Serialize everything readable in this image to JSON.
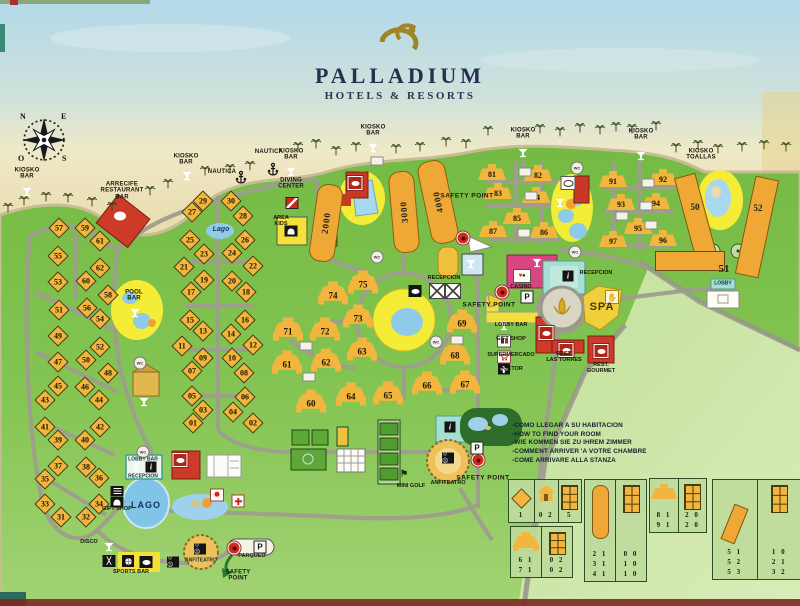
{
  "header": {
    "brand": "PALLADIUM",
    "tagline": "HOTELS & RESORTS"
  },
  "compass": {
    "n": "N",
    "e": "E",
    "o": "O",
    "s": "S"
  },
  "buildings": {
    "diamonds": [
      [
        57,
        59,
        228
      ],
      [
        59,
        85,
        228
      ],
      [
        61,
        100,
        241
      ],
      [
        55,
        58,
        256
      ],
      [
        62,
        100,
        268
      ],
      [
        60,
        86,
        281
      ],
      [
        53,
        58,
        282
      ],
      [
        58,
        108,
        295
      ],
      [
        56,
        87,
        308
      ],
      [
        51,
        59,
        310
      ],
      [
        54,
        100,
        319
      ],
      [
        49,
        58,
        336
      ],
      [
        52,
        100,
        347
      ],
      [
        50,
        86,
        360
      ],
      [
        47,
        58,
        362
      ],
      [
        48,
        108,
        373
      ],
      [
        45,
        58,
        386
      ],
      [
        46,
        85,
        387
      ],
      [
        43,
        45,
        400
      ],
      [
        44,
        99,
        400
      ],
      [
        41,
        45,
        427
      ],
      [
        42,
        100,
        427
      ],
      [
        39,
        58,
        440
      ],
      [
        40,
        85,
        440
      ],
      [
        37,
        58,
        466
      ],
      [
        38,
        86,
        467
      ],
      [
        35,
        45,
        479
      ],
      [
        36,
        99,
        478
      ],
      [
        33,
        45,
        504
      ],
      [
        34,
        99,
        504
      ],
      [
        31,
        61,
        517
      ],
      [
        32,
        86,
        517
      ],
      [
        29,
        203,
        201
      ],
      [
        30,
        231,
        201
      ],
      [
        27,
        192,
        212
      ],
      [
        28,
        243,
        216
      ],
      [
        25,
        190,
        240
      ],
      [
        26,
        245,
        240
      ],
      [
        23,
        204,
        254
      ],
      [
        24,
        232,
        253
      ],
      [
        21,
        184,
        267
      ],
      [
        22,
        253,
        266
      ],
      [
        19,
        204,
        280
      ],
      [
        20,
        232,
        281
      ],
      [
        17,
        191,
        292
      ],
      [
        18,
        246,
        292
      ],
      [
        15,
        190,
        320
      ],
      [
        16,
        245,
        320
      ],
      [
        13,
        203,
        331
      ],
      [
        14,
        231,
        334
      ],
      [
        11,
        182,
        346
      ],
      [
        12,
        253,
        345
      ],
      [
        "09",
        203,
        358
      ],
      [
        10,
        232,
        358
      ],
      [
        "07",
        192,
        371
      ],
      [
        "08",
        244,
        373
      ],
      [
        "05",
        192,
        396
      ],
      [
        "06",
        245,
        397
      ],
      [
        "03",
        203,
        410
      ],
      [
        "04",
        233,
        412
      ],
      [
        "01",
        193,
        423
      ],
      [
        "02",
        253,
        423
      ]
    ],
    "bells": [
      [
        60,
        311,
        401
      ],
      [
        61,
        287,
        362
      ],
      [
        62,
        326,
        360
      ],
      [
        63,
        362,
        349
      ],
      [
        64,
        351,
        394
      ],
      [
        65,
        388,
        393
      ],
      [
        66,
        427,
        383
      ],
      [
        67,
        465,
        382
      ],
      [
        68,
        455,
        353
      ],
      [
        69,
        462,
        321
      ],
      [
        71,
        288,
        329
      ],
      [
        72,
        325,
        329
      ],
      [
        73,
        358,
        316
      ],
      [
        74,
        333,
        293
      ],
      [
        75,
        363,
        282
      ]
    ],
    "traps": [
      [
        81,
        492,
        172
      ],
      [
        82,
        538,
        173
      ],
      [
        83,
        498,
        191
      ],
      [
        84,
        536,
        195
      ],
      [
        85,
        517,
        216
      ],
      [
        86,
        544,
        230
      ],
      [
        87,
        493,
        229
      ],
      [
        91,
        613,
        179
      ],
      [
        92,
        663,
        177
      ],
      [
        93,
        621,
        202
      ],
      [
        94,
        656,
        201
      ],
      [
        95,
        638,
        226
      ],
      [
        96,
        663,
        238
      ],
      [
        97,
        613,
        239
      ]
    ],
    "towers": [
      [
        "2000",
        326,
        223,
        8,
        24,
        76
      ],
      [
        "3000",
        404,
        212,
        -5,
        24,
        80
      ],
      [
        "4000",
        438,
        202,
        -12,
        26,
        82
      ]
    ],
    "slant_rects": [
      [
        686,
        174,
        20,
        94,
        -15
      ],
      [
        745,
        177,
        22,
        98,
        12
      ]
    ],
    "long51": {
      "x": 690,
      "y": 261,
      "w": 68,
      "h": 18
    }
  },
  "labels": [
    [
      "KIOSKO\nBAR",
      27,
      174,
      "t"
    ],
    [
      "KIOSKO\nBAR",
      186,
      160,
      "t"
    ],
    [
      "KIOSKO\nBAR",
      291,
      155,
      "t"
    ],
    [
      "KIOSKO\nBAR",
      373,
      131,
      "t"
    ],
    [
      "KIOSKO\nBAR",
      523,
      134,
      "t"
    ],
    [
      "KIOSKO\nBAR",
      641,
      135,
      "t"
    ],
    [
      "KIOSKO\nTOALLAS",
      701,
      155,
      "t"
    ],
    [
      "NAUTICA",
      222,
      172,
      "t"
    ],
    [
      "NAUTICA",
      269,
      152,
      "t"
    ],
    [
      "ARRECIFE\nRESTAURANT\nBAR",
      122,
      191,
      "t"
    ],
    [
      "DIVING\nCENTER",
      291,
      184,
      "t"
    ],
    [
      "AREA\nKIDS",
      281,
      222,
      "t5"
    ],
    [
      "Lago",
      221,
      230,
      "it"
    ],
    [
      "POOL\nBAR",
      134,
      296,
      "t"
    ],
    [
      "SPA",
      602,
      308,
      "spa"
    ],
    [
      "LAGO",
      146,
      506,
      "lago"
    ],
    [
      "RECEPCION",
      444,
      279,
      "t5"
    ],
    [
      "RECEPCION",
      596,
      274,
      "t5"
    ],
    [
      "CASINO",
      521,
      288,
      "t5"
    ],
    [
      "LOBBY BAR",
      511,
      326,
      "tl"
    ],
    [
      "GIFT SHOP",
      511,
      340,
      "tl"
    ],
    [
      "SUPERMERCADO",
      511,
      356,
      "tl"
    ],
    [
      "DOCTOR",
      511,
      370,
      "tl"
    ],
    [
      "REST.\nLAS TORRES",
      564,
      358,
      "t5"
    ],
    [
      "REST.\nGOURMET",
      601,
      369,
      "t5"
    ],
    [
      "GIFT SHOP",
      117,
      510,
      "t5"
    ],
    [
      "LOBBY BAR",
      143,
      460,
      "t4"
    ],
    [
      "RECEPCION",
      143,
      477,
      "t4"
    ],
    [
      "ANFITEATRO",
      201,
      561,
      "t4"
    ],
    [
      "ANFITEATRO",
      448,
      484,
      "t5"
    ],
    [
      "PARQUEO",
      252,
      557,
      "t5"
    ],
    [
      "SAFETY\nPOINT",
      238,
      576,
      "t"
    ],
    [
      "DISCO",
      89,
      543,
      "t5"
    ],
    [
      "SPORTS BAR",
      131,
      573,
      "t5"
    ],
    [
      "MINI GOLF",
      411,
      487,
      "t5"
    ],
    [
      "LOBBY",
      723,
      284,
      "t4"
    ],
    [
      "SAFETY POINT",
      467,
      196,
      "v"
    ],
    [
      "SAFETY POINT",
      489,
      305,
      "v"
    ],
    [
      "SAFETY POINT",
      483,
      478,
      "v"
    ],
    [
      "50",
      695,
      208,
      "num"
    ],
    [
      "52",
      758,
      209,
      "num"
    ],
    [
      "51",
      724,
      270,
      "num10"
    ]
  ],
  "icons": [
    [
      "martini",
      27,
      192
    ],
    [
      "martini",
      187,
      176
    ],
    [
      "martini",
      291,
      172
    ],
    [
      "martini",
      373,
      148
    ],
    [
      "martini",
      523,
      153
    ],
    [
      "martini",
      641,
      156
    ],
    [
      "martini",
      135,
      313
    ],
    [
      "martini",
      471,
      264
    ],
    [
      "martini",
      537,
      263
    ],
    [
      "martini",
      560,
      203
    ],
    [
      "martini",
      144,
      402
    ],
    [
      "martini",
      136,
      467
    ],
    [
      "martini",
      109,
      547
    ],
    [
      "martini",
      504,
      326
    ],
    [
      "martiniR",
      424,
      305
    ],
    [
      "anchor",
      241,
      178
    ],
    [
      "anchor",
      273,
      170
    ],
    [
      "wc",
      377,
      257
    ],
    [
      "wc",
      436,
      342
    ],
    [
      "wc",
      140,
      363
    ],
    [
      "wc",
      143,
      452
    ],
    [
      "wc",
      577,
      168
    ],
    [
      "wc",
      575,
      252
    ],
    [
      "dot",
      463,
      238
    ],
    [
      "dot",
      502,
      292
    ],
    [
      "dot",
      478,
      460
    ],
    [
      "dot",
      234,
      548
    ],
    [
      "P",
      527,
      297
    ],
    [
      "P",
      477,
      448
    ],
    [
      "P",
      260,
      547
    ],
    [
      "flag",
      292,
      203
    ],
    [
      "info",
      568,
      276
    ],
    [
      "info",
      450,
      427
    ],
    [
      "info",
      151,
      467
    ],
    [
      "cards",
      522,
      276
    ],
    [
      "masks",
      173,
      562
    ],
    [
      "masks",
      200,
      549
    ],
    [
      "masks",
      448,
      458
    ],
    [
      "rest",
      415,
      291
    ],
    [
      "rest",
      146,
      562
    ],
    [
      "restR",
      546,
      333
    ],
    [
      "restR",
      566,
      350
    ],
    [
      "restR",
      601,
      351
    ],
    [
      "restR",
      355,
      183
    ],
    [
      "restR",
      180,
      460
    ],
    [
      "restW",
      568,
      183
    ],
    [
      "burger",
      117,
      491
    ],
    [
      "arch",
      117,
      502
    ],
    [
      "arch",
      291,
      231
    ],
    [
      "shop",
      504,
      341
    ],
    [
      "cart",
      504,
      357
    ],
    [
      "crossB",
      504,
      369
    ],
    [
      "gear",
      217,
      495
    ],
    [
      "crossR",
      238,
      501
    ],
    [
      "hand",
      612,
      297
    ],
    [
      "golf",
      404,
      474
    ],
    [
      "sportX",
      109,
      561
    ],
    [
      "ball",
      128,
      561
    ],
    [
      "xbox",
      437,
      291
    ],
    [
      "xbox",
      453,
      291
    ],
    [
      "chip",
      306,
      346
    ],
    [
      "chip",
      309,
      377
    ],
    [
      "chip",
      457,
      340
    ],
    [
      "chip",
      525,
      172
    ],
    [
      "chip",
      531,
      196
    ],
    [
      "chip",
      524,
      233
    ],
    [
      "chip",
      648,
      183
    ],
    [
      "chip",
      646,
      206
    ],
    [
      "chip",
      622,
      216
    ],
    [
      "chip",
      651,
      225
    ],
    [
      "chip",
      377,
      161
    ],
    [
      "palm",
      8,
      207
    ],
    [
      "palm",
      24,
      200
    ],
    [
      "palm",
      46,
      196
    ],
    [
      "palm",
      68,
      197
    ],
    [
      "palm",
      92,
      201
    ],
    [
      "palm",
      112,
      206
    ],
    [
      "palm",
      150,
      190
    ],
    [
      "palm",
      168,
      183
    ],
    [
      "palm",
      205,
      170
    ],
    [
      "palm",
      230,
      168
    ],
    [
      "palm",
      250,
      165
    ],
    [
      "palm",
      298,
      146
    ],
    [
      "palm",
      316,
      143
    ],
    [
      "palm",
      336,
      150
    ],
    [
      "palm",
      356,
      146
    ],
    [
      "palm",
      396,
      148
    ],
    [
      "palm",
      420,
      146
    ],
    [
      "palm",
      446,
      141
    ],
    [
      "palm",
      466,
      143
    ],
    [
      "palm",
      488,
      130
    ],
    [
      "palm",
      540,
      128
    ],
    [
      "palm",
      560,
      131
    ],
    [
      "palm",
      580,
      127
    ],
    [
      "palm",
      600,
      129
    ],
    [
      "palm",
      616,
      126
    ],
    [
      "palm",
      632,
      128
    ],
    [
      "palm",
      656,
      125
    ],
    [
      "palm",
      676,
      147
    ],
    [
      "palm",
      698,
      144
    ],
    [
      "palm",
      718,
      148
    ],
    [
      "palm",
      742,
      146
    ],
    [
      "palm",
      764,
      144
    ],
    [
      "palm",
      786,
      146
    ]
  ],
  "legend": {
    "panels": [
      {
        "x": 508,
        "y": 479,
        "w": 72,
        "h": 42,
        "cells": [
          {
            "shape": "diamond",
            "nums": [
              "1"
            ]
          },
          {
            "shape": "house",
            "nums": [
              "0 2"
            ]
          },
          {
            "shape": "grid",
            "nums": [
              "5"
            ]
          }
        ]
      },
      {
        "x": 510,
        "y": 526,
        "w": 61,
        "h": 50,
        "cells": [
          {
            "shape": "bell",
            "nums": [
              "6 1",
              "7 1"
            ]
          },
          {
            "shape": "grid",
            "nums": [
              "0 2",
              "0 2"
            ]
          }
        ]
      },
      {
        "x": 584,
        "y": 479,
        "w": 61,
        "h": 101,
        "cells": [
          {
            "shape": "tower",
            "nums": [
              "2 1",
              "3 1",
              "4 1"
            ]
          },
          {
            "shape": "grid",
            "nums": [
              "0 0",
              "1 0",
              "1 0"
            ]
          }
        ]
      },
      {
        "x": 649,
        "y": 478,
        "w": 56,
        "h": 53,
        "cells": [
          {
            "shape": "trap",
            "nums": [
              "8 1",
              "9 1"
            ]
          },
          {
            "shape": "grid",
            "nums": [
              "2 0",
              "2 0"
            ]
          }
        ]
      },
      {
        "x": 712,
        "y": 479,
        "w": 88,
        "h": 99,
        "cells": [
          {
            "shape": "slant",
            "nums": [
              "5 1",
              "5 2",
              "5 3"
            ]
          },
          {
            "shape": "grid",
            "nums": [
              "1 0",
              "2 1",
              "3 2"
            ]
          }
        ]
      }
    ]
  },
  "howto": {
    "lines": [
      "-COMO LLEGAR A SU HABITACION",
      "-HOW TO FIND YOUR ROOM",
      "-WIE KOMMEN SIE ZU IHREM ZIMMER",
      "-COMMENT ARRIVER 'A VOTRE CHAMBRE",
      "-COME ARRIVARE ALLA STANZA"
    ]
  }
}
